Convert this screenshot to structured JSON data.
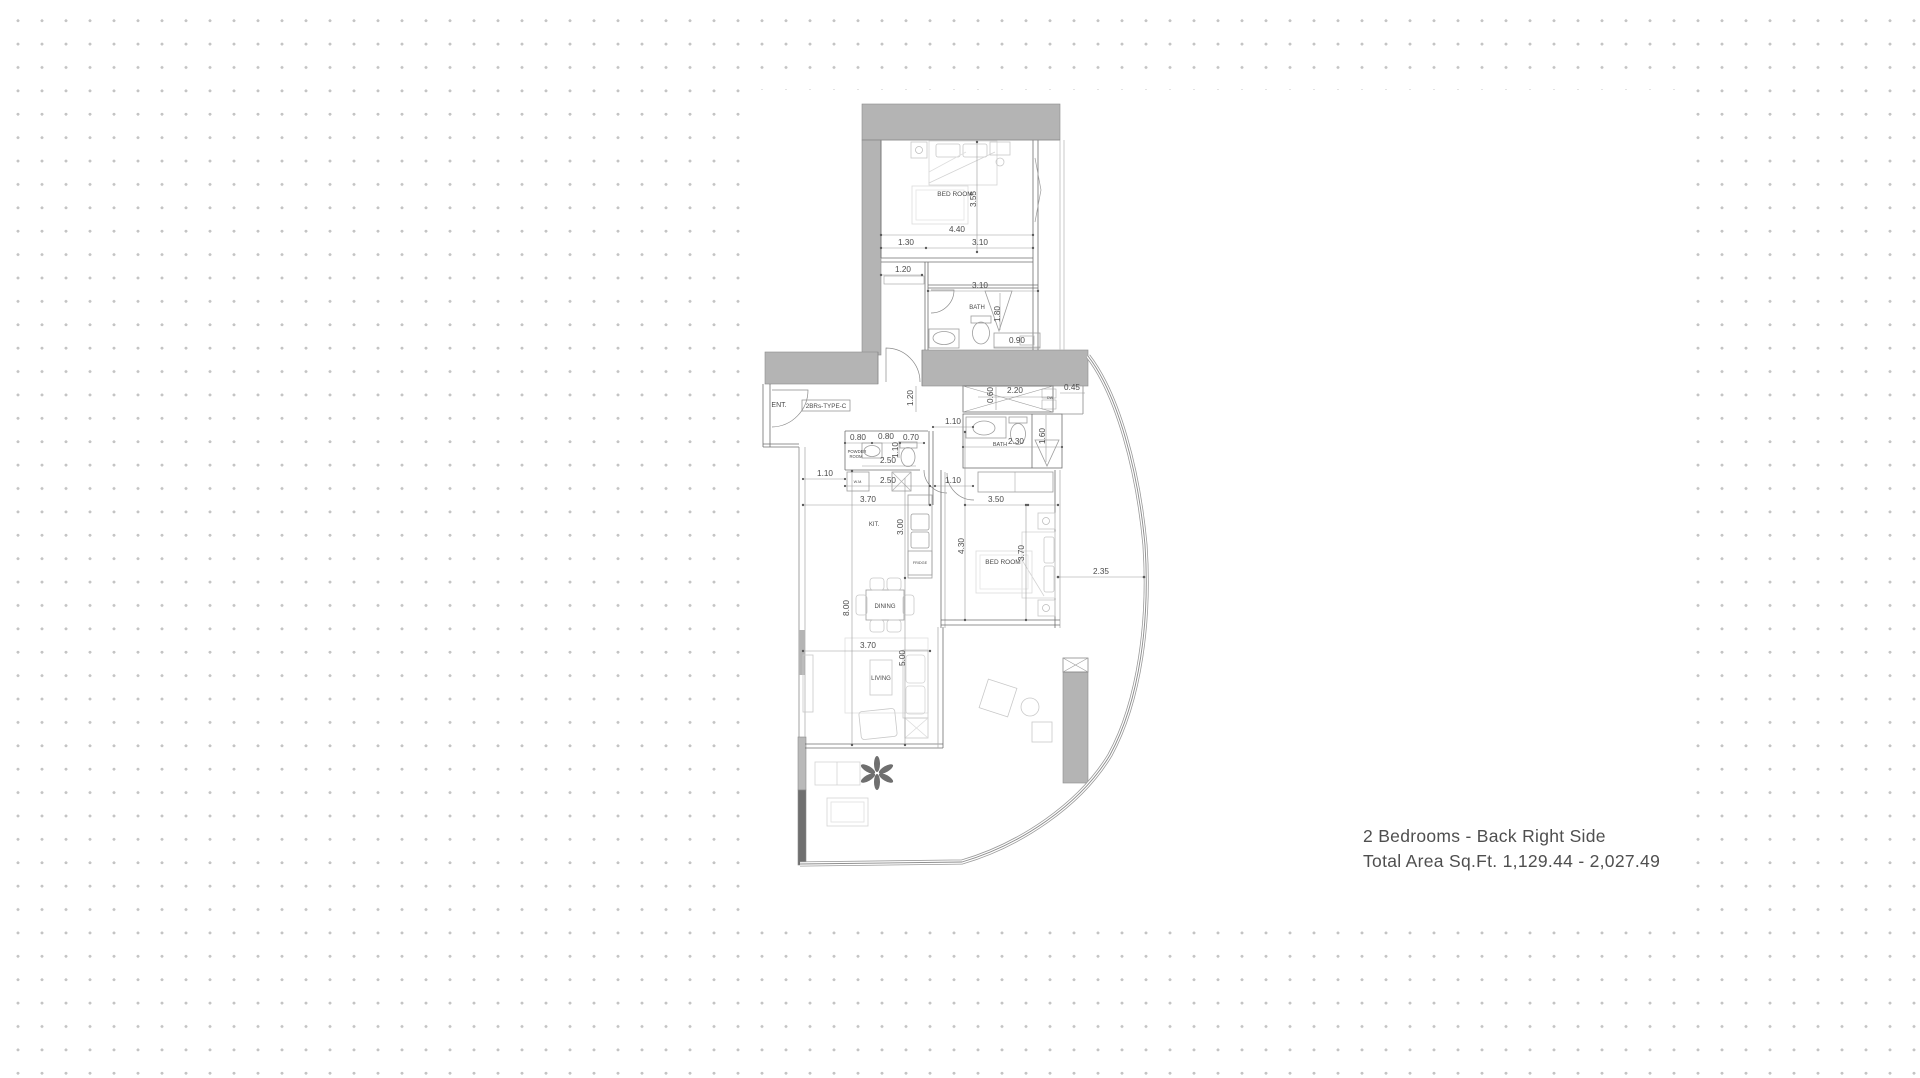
{
  "caption": {
    "title": "2 Bedrooms - Back Right Side",
    "subtitle": "Total Area Sq.Ft. 1,129.44 - 2,027.49"
  },
  "plan": {
    "type_label": "2BRs-TYPE-C",
    "colors": {
      "wall": "#b4b4b4",
      "wall_dark": "#6f6f6f",
      "line": "#6f6f6f",
      "light": "#cfcfcf",
      "dim_text": "#4a4a4a",
      "caption_text": "#4f4f4f",
      "dot": "#c4c4c4"
    },
    "room_labels": [
      {
        "text": "BED ROOM",
        "x": 955,
        "y": 196,
        "size": 6.5
      },
      {
        "text": "BATH",
        "x": 977,
        "y": 309,
        "size": 6
      },
      {
        "text": "ENT.",
        "x": 779,
        "y": 407,
        "size": 7
      },
      {
        "text": "POWDER",
        "x": 857,
        "y": 453,
        "size": 4.2
      },
      {
        "text": "ROOM",
        "x": 856,
        "y": 458,
        "size": 4.2
      },
      {
        "text": "W.M.",
        "x": 858,
        "y": 483,
        "size": 3.8
      },
      {
        "text": "BATH",
        "x": 1000,
        "y": 446,
        "size": 5.5
      },
      {
        "text": "DW",
        "x": 1050,
        "y": 399,
        "size": 3.6
      },
      {
        "text": "KIT.",
        "x": 874,
        "y": 526,
        "size": 6
      },
      {
        "text": "FRIDGE",
        "x": 920,
        "y": 564,
        "size": 3.8
      },
      {
        "text": "BED ROOM",
        "x": 1003,
        "y": 564,
        "size": 6.5
      },
      {
        "text": "DINING",
        "x": 885,
        "y": 608,
        "size": 6
      },
      {
        "text": "LIVING",
        "x": 881,
        "y": 680,
        "size": 6
      }
    ],
    "dim_labels": [
      {
        "text": "3.55",
        "x": 976,
        "y": 199,
        "rot": -90
      },
      {
        "text": "4.40",
        "x": 957,
        "y": 232
      },
      {
        "text": "1.30",
        "x": 906,
        "y": 245
      },
      {
        "text": "3.10",
        "x": 980,
        "y": 245
      },
      {
        "text": "1.20",
        "x": 903,
        "y": 272
      },
      {
        "text": "3.10",
        "x": 980,
        "y": 288
      },
      {
        "text": "1.80",
        "x": 1000,
        "y": 314,
        "rot": -90
      },
      {
        "text": "0.90",
        "x": 1017,
        "y": 343
      },
      {
        "text": "1.20",
        "x": 913,
        "y": 398,
        "rot": -90
      },
      {
        "text": "0.60",
        "x": 993,
        "y": 395,
        "rot": -90
      },
      {
        "text": "2.20",
        "x": 1015,
        "y": 393
      },
      {
        "text": "0.45",
        "x": 1072,
        "y": 390
      },
      {
        "text": "1.10",
        "x": 953,
        "y": 424
      },
      {
        "text": "0.80",
        "x": 858,
        "y": 440
      },
      {
        "text": "0.80",
        "x": 886,
        "y": 439
      },
      {
        "text": "0.70",
        "x": 911,
        "y": 440
      },
      {
        "text": "1.10",
        "x": 898,
        "y": 450,
        "rot": -90
      },
      {
        "text": "2.50",
        "x": 888,
        "y": 463
      },
      {
        "text": "2.30",
        "x": 1016,
        "y": 444
      },
      {
        "text": "1.60",
        "x": 1045,
        "y": 436,
        "rot": -90
      },
      {
        "text": "1.10",
        "x": 825,
        "y": 476
      },
      {
        "text": "2.50",
        "x": 888,
        "y": 483
      },
      {
        "text": "1.10",
        "x": 953,
        "y": 483
      },
      {
        "text": "3.70",
        "x": 868,
        "y": 502
      },
      {
        "text": "3.50",
        "x": 996,
        "y": 502
      },
      {
        "text": "3.00",
        "x": 903,
        "y": 527,
        "rot": -90
      },
      {
        "text": "4.30",
        "x": 964,
        "y": 546,
        "rot": -90
      },
      {
        "text": "3.70",
        "x": 1024,
        "y": 553,
        "rot": -90
      },
      {
        "text": "2.35",
        "x": 1101,
        "y": 574
      },
      {
        "text": "8.00",
        "x": 849,
        "y": 608,
        "rot": -90
      },
      {
        "text": "3.70",
        "x": 868,
        "y": 648
      },
      {
        "text": "5.00",
        "x": 905,
        "y": 658,
        "rot": -90
      }
    ]
  }
}
